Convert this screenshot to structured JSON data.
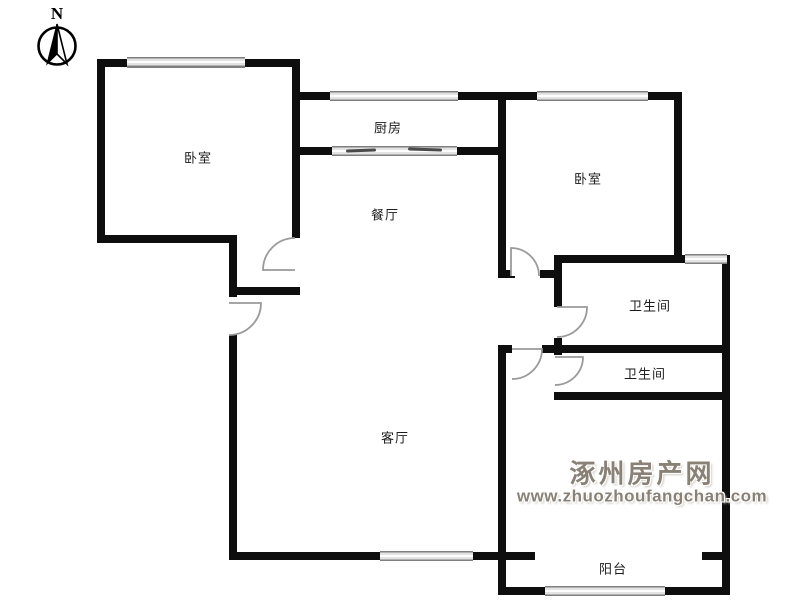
{
  "compass": {
    "north_label": "N"
  },
  "rooms": {
    "bedroom_left": {
      "label": "卧室"
    },
    "kitchen": {
      "label": "厨房"
    },
    "dining": {
      "label": "餐厅"
    },
    "bedroom_right": {
      "label": "卧室"
    },
    "bathroom_top": {
      "label": "卫生间"
    },
    "bathroom_bottom": {
      "label": "卫生间"
    },
    "living": {
      "label": "客厅"
    },
    "balcony": {
      "label": "阳台"
    }
  },
  "watermark": {
    "site_name": "涿州房产网",
    "site_url": "www.zhuozhoufangchan.com"
  },
  "colors": {
    "wall": "#0e0e0e",
    "window_frame": "#7f7f7f",
    "door_arc": "#9a9a9a",
    "watermark_text": "#8a8176"
  }
}
